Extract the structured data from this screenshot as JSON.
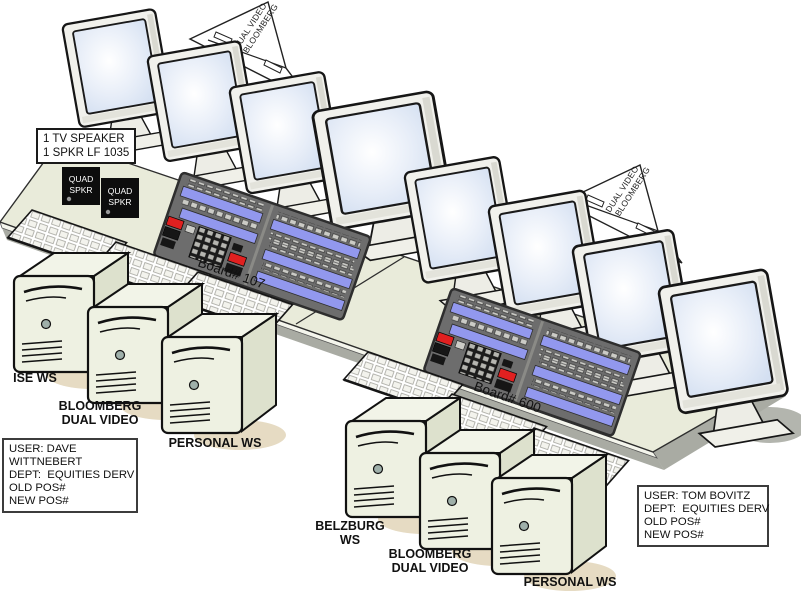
{
  "scene": {
    "arrows": [
      {
        "line1": "DUAL VIDEO",
        "line2": "BLOOMBERG"
      },
      {
        "line1": "DUAL VIDEO",
        "line2": "BLOOMBERG"
      }
    ],
    "speaker_note": {
      "line1": "1 TV SPEAKER",
      "line2": "1 SPKR LF 1035"
    },
    "quad_speakers": [
      {
        "line1": "QUAD",
        "line2": "SPKR"
      },
      {
        "line1": "QUAD",
        "line2": "SPKR"
      }
    ],
    "boards": [
      {
        "label": "Board# 107"
      },
      {
        "label": "Board# 600"
      }
    ],
    "user_boxes": [
      {
        "line1": "USER: DAVE",
        "line2": "WITTNEBERT",
        "line3": "DEPT:  EQUITIES DERV",
        "line4": "OLD POS#",
        "line5": "NEW POS#"
      },
      {
        "line1": "USER: TOM BOVITZ",
        "line2": "DEPT:  EQUITIES DERV",
        "line3": "OLD POS#",
        "line4": "NEW POS#"
      }
    ],
    "workstations": [
      {
        "line1": "ISE WS"
      },
      {
        "line1": "BLOOMBERG",
        "line2": "DUAL VIDEO"
      },
      {
        "line1": "PERSONAL WS"
      },
      {
        "line1": "BELZBURG",
        "line2": "WS"
      },
      {
        "line1": "BLOOMBERG",
        "line2": "DUAL VIDEO"
      },
      {
        "line1": "PERSONAL WS"
      }
    ],
    "equipment_counts": {
      "monitors": 8,
      "keyboards": 6,
      "workstation_towers": 6,
      "turret_boards": 2,
      "quad_speakers": 2
    },
    "colors": {
      "desk": "#e9ebda",
      "desk_shadow": "#a9aba3",
      "tower_front": "#eef1e2",
      "tower_side": "#dde1cd",
      "tower_top": "#f2f4e8",
      "monitor_bezel": "#f1f1ec",
      "screen_blue": "#d9e4f3",
      "turret_panel": "#6d6d6d",
      "turret_lcd": "#9298ee",
      "button_red": "#e02020",
      "floor_shadow_tan": "#e6dbc3",
      "speaker_black": "#0d0d0d"
    }
  }
}
